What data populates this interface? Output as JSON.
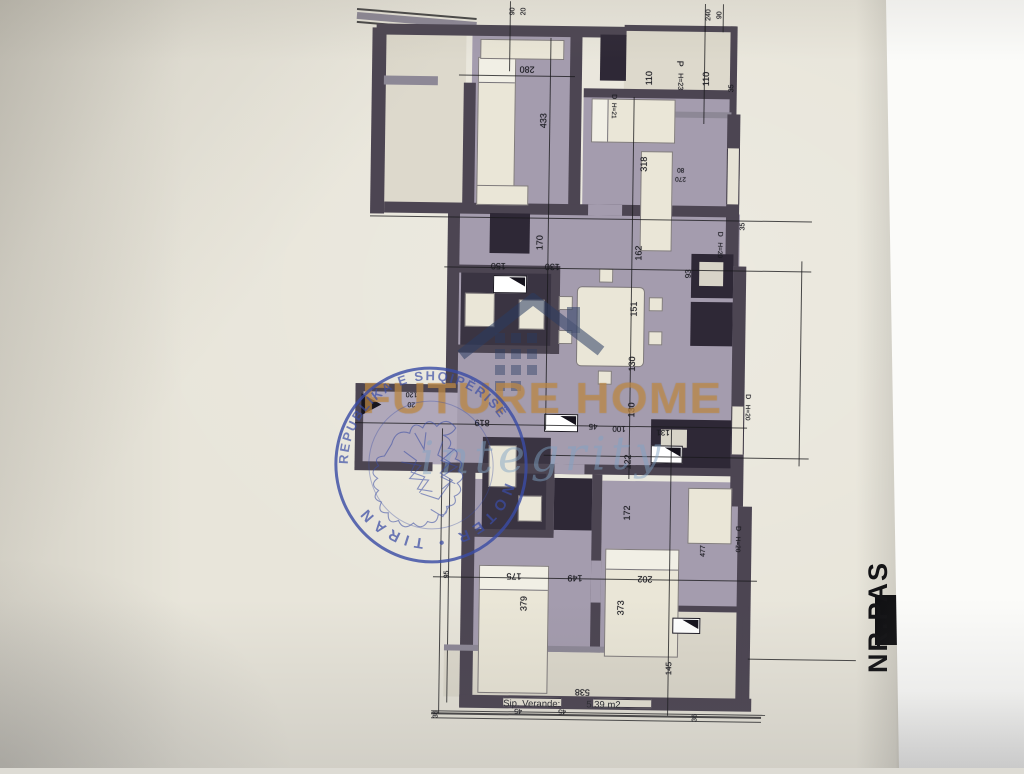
{
  "document": {
    "type": "photographed floor plan sheet",
    "veranda": {
      "label": "Sip. Verande:",
      "value": "5.39 m2"
    },
    "side_text": "NR.PAS"
  },
  "colors": {
    "paper": "#e8e5da",
    "wall": "#4c4552",
    "floor": "#a49cae",
    "stamp_blue": "#3b4da5",
    "watermark_tan": "#c49250"
  },
  "watermark": {
    "title": "FUTURE HOME",
    "script": "integrity",
    "logo": "house-roof-icon"
  },
  "stamp": {
    "arc_top": "REPUBLIKA E SHQIPËRISË",
    "arc_bottom": "NOTER • TIRANË",
    "emblem": "double-headed-eagle"
  },
  "plan": {
    "dims": [
      {
        "t": "90",
        "x": 508,
        "y": 12,
        "r": -90,
        "s": 7
      },
      {
        "t": "20",
        "x": 519,
        "y": 12,
        "r": -90,
        "s": 7
      },
      {
        "t": "240",
        "x": 704,
        "y": 13,
        "r": -90,
        "s": 7
      },
      {
        "t": "90",
        "x": 715,
        "y": 13,
        "r": -90,
        "s": 7
      },
      {
        "t": "280",
        "x": 523,
        "y": 70,
        "r": 180,
        "s": 9
      },
      {
        "t": "110",
        "x": 645,
        "y": 77,
        "r": -90,
        "s": 9
      },
      {
        "t": "110",
        "x": 702,
        "y": 77,
        "r": -90,
        "s": 9
      },
      {
        "t": "35",
        "x": 728,
        "y": 86,
        "r": -90,
        "s": 7
      },
      {
        "t": "P",
        "x": 676,
        "y": 62,
        "r": 90,
        "s": 9
      },
      {
        "t": "H=23",
        "x": 676,
        "y": 80,
        "r": 90,
        "s": 7
      },
      {
        "t": "D",
        "x": 610,
        "y": 96,
        "r": 90,
        "s": 7
      },
      {
        "t": "H=21",
        "x": 610,
        "y": 110,
        "r": 90,
        "s": 6.5
      },
      {
        "t": "433",
        "x": 540,
        "y": 121,
        "r": -90,
        "s": 9
      },
      {
        "t": "318",
        "x": 641,
        "y": 163,
        "r": -90,
        "s": 9
      },
      {
        "t": "80",
        "x": 678,
        "y": 168,
        "r": 180,
        "s": 6.5
      },
      {
        "t": "270",
        "x": 678,
        "y": 177,
        "r": 180,
        "s": 6.5
      },
      {
        "t": "35",
        "x": 741,
        "y": 224,
        "r": -90,
        "s": 7
      },
      {
        "t": "170",
        "x": 538,
        "y": 243,
        "r": -90,
        "s": 9
      },
      {
        "t": "162",
        "x": 637,
        "y": 252,
        "r": -90,
        "s": 9
      },
      {
        "t": "150",
        "x": 497,
        "y": 267,
        "r": 180,
        "s": 9
      },
      {
        "t": "130",
        "x": 551,
        "y": 267,
        "r": 180,
        "s": 9
      },
      {
        "t": "93",
        "x": 687,
        "y": 272,
        "r": -90,
        "s": 8
      },
      {
        "t": "D",
        "x": 718,
        "y": 232,
        "r": 90,
        "s": 7
      },
      {
        "t": "H=20",
        "x": 718,
        "y": 248,
        "r": 90,
        "s": 6.5
      },
      {
        "t": "151",
        "x": 633,
        "y": 308,
        "r": -90,
        "s": 9
      },
      {
        "t": "130",
        "x": 632,
        "y": 363,
        "r": -90,
        "s": 9
      },
      {
        "t": "130",
        "x": 632,
        "y": 409,
        "r": -90,
        "s": 9
      },
      {
        "t": "120",
        "x": 412,
        "y": 396,
        "r": 180,
        "s": 7
      },
      {
        "t": "20",
        "x": 412,
        "y": 406,
        "r": 180,
        "s": 7
      },
      {
        "t": "819",
        "x": 483,
        "y": 424,
        "r": 180,
        "s": 9
      },
      {
        "t": "45",
        "x": 594,
        "y": 426,
        "r": 180,
        "s": 8
      },
      {
        "t": "100",
        "x": 620,
        "y": 428,
        "r": 180,
        "s": 8
      },
      {
        "t": "131",
        "x": 664,
        "y": 431,
        "r": 180,
        "s": 8
      },
      {
        "t": "D",
        "x": 748,
        "y": 394,
        "r": 90,
        "s": 7
      },
      {
        "t": "H=20",
        "x": 748,
        "y": 410,
        "r": 90,
        "s": 6.5
      },
      {
        "t": "122",
        "x": 629,
        "y": 461,
        "r": -90,
        "s": 9
      },
      {
        "t": "172",
        "x": 629,
        "y": 512,
        "r": -90,
        "s": 9
      },
      {
        "t": "477",
        "x": 706,
        "y": 549,
        "r": -90,
        "s": 7
      },
      {
        "t": "D",
        "x": 740,
        "y": 526,
        "r": 90,
        "s": 7
      },
      {
        "t": "H=20",
        "x": 740,
        "y": 542,
        "r": 90,
        "s": 6.5
      },
      {
        "t": "95",
        "x": 450,
        "y": 576,
        "r": -90,
        "s": 7
      },
      {
        "t": "175",
        "x": 517,
        "y": 577,
        "r": 180,
        "s": 9
      },
      {
        "t": "149",
        "x": 578,
        "y": 578,
        "r": 180,
        "s": 9
      },
      {
        "t": "202",
        "x": 648,
        "y": 578,
        "r": 180,
        "s": 9
      },
      {
        "t": "379",
        "x": 527,
        "y": 604,
        "r": -90,
        "s": 9
      },
      {
        "t": "373",
        "x": 624,
        "y": 607,
        "r": -90,
        "s": 9
      },
      {
        "t": "145",
        "x": 673,
        "y": 667,
        "r": -90,
        "s": 8
      },
      {
        "t": "538",
        "x": 587,
        "y": 692,
        "r": 180,
        "s": 9
      },
      {
        "t": "45",
        "x": 523,
        "y": 711,
        "r": 180,
        "s": 7
      },
      {
        "t": "45",
        "x": 567,
        "y": 711,
        "r": 180,
        "s": 7
      },
      {
        "t": "36",
        "x": 441,
        "y": 716,
        "r": -90,
        "s": 7
      },
      {
        "t": "36",
        "x": 700,
        "y": 716,
        "r": -90,
        "s": 7
      }
    ]
  }
}
